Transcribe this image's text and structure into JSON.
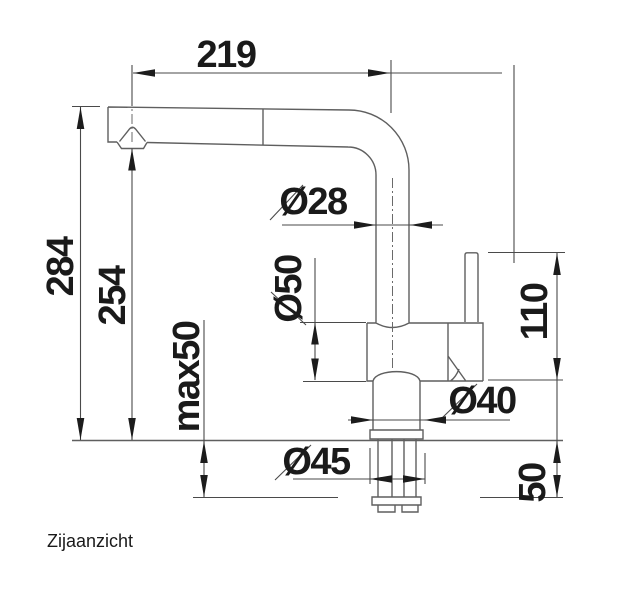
{
  "caption": "Zijaanzicht",
  "dims": {
    "projection": "219",
    "height_total": "284",
    "height_outlet": "254",
    "counter_max": "max50",
    "spout_dia": "Ø28",
    "body_dia": "Ø50",
    "lever_height": "110",
    "base_dia": "Ø40",
    "shank_dia": "Ø45",
    "below_counter": "50"
  },
  "colors": {
    "outline": "#5f5f5f",
    "dimension_line": "#4a4a4a",
    "centerline": "#6a6a6a",
    "text": "#1a1a1a",
    "background": "#ffffff"
  }
}
